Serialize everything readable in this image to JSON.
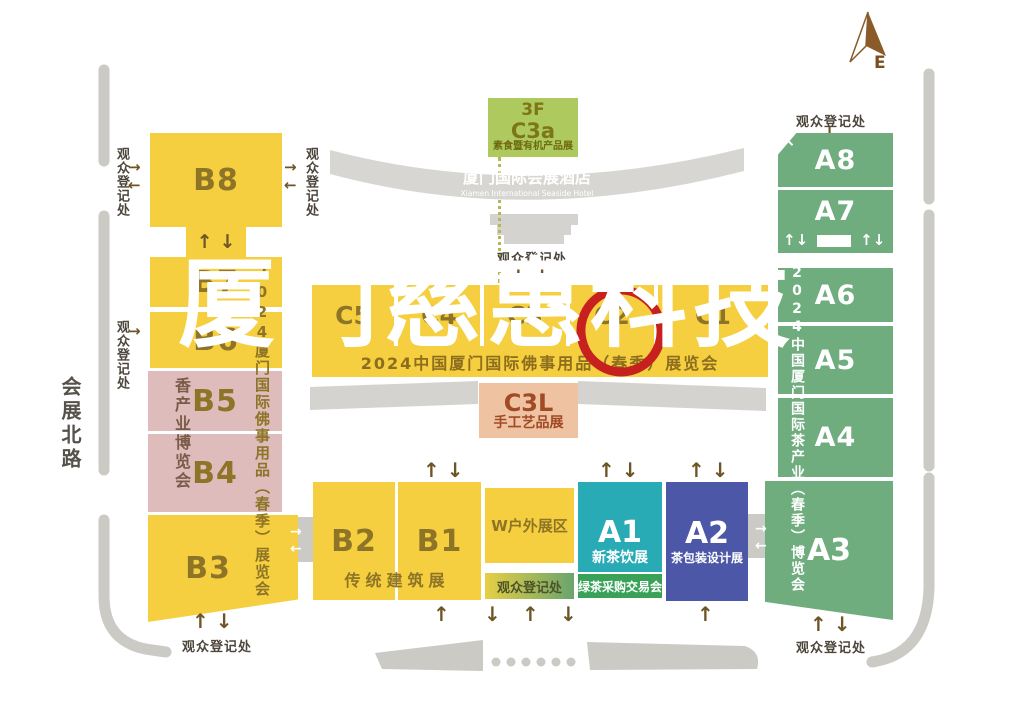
{
  "watermark": {
    "text": "厦门慈惠科技"
  },
  "compass": {
    "label": "E"
  },
  "street": {
    "name": "会展北路"
  },
  "registration_label": "观众登记处",
  "icons": {
    "up": "↑",
    "down": "↓",
    "left": "←",
    "right": "→",
    "up_left": "↖"
  },
  "top_area": {
    "c3a": {
      "floor": "3F",
      "hall": "C3a",
      "expo": "素食暨有机产品展"
    },
    "hotel": {
      "name": "厦门国际会展酒店",
      "name_en": "Xiamen International Seaside Hotel"
    }
  },
  "a_side": {
    "halls": [
      "A8",
      "A7",
      "A6",
      "A5",
      "A4",
      "A3"
    ],
    "expo": "2024中国厦门国际茶产业（春季）博览会"
  },
  "b_side": {
    "halls": [
      "B8",
      "B7",
      "B6",
      "B5",
      "B4",
      "B3"
    ],
    "expo": "2024厦门国际佛事用品（春季）展览会",
    "incense_expo": "香产业博览会"
  },
  "c_band": {
    "halls": [
      "C5",
      "C4",
      "C3",
      "C2",
      "C1"
    ],
    "expo": "2024中国厦门国际佛事用品（春季）展览会"
  },
  "c3l": {
    "hall": "C3L",
    "expo": "手工艺品展"
  },
  "south_area": {
    "b2": "B2",
    "b1": "B1",
    "b_expo": "传统建筑展",
    "w_area": "W户外展区",
    "a1": "A1",
    "a1_expo": "新茶饮展",
    "a1_strip": "绿茶采购交易会",
    "a2": "A2",
    "a2_expo": "茶包装设计展"
  },
  "colors": {
    "hall_yellow": "#f5cf3f",
    "hall_pink": "#debcbc",
    "hall_green": "#6fac7e",
    "hall_teal": "#29abb6",
    "hall_indigo": "#4c57a8",
    "c3a_lime": "#aeca5f",
    "c3l_peach": "#efc2a2",
    "strip_green": "#3aa258",
    "road_gray": "#cccac5",
    "arrow_brown": "#6d5526",
    "watermark_red": "#c7211f"
  }
}
